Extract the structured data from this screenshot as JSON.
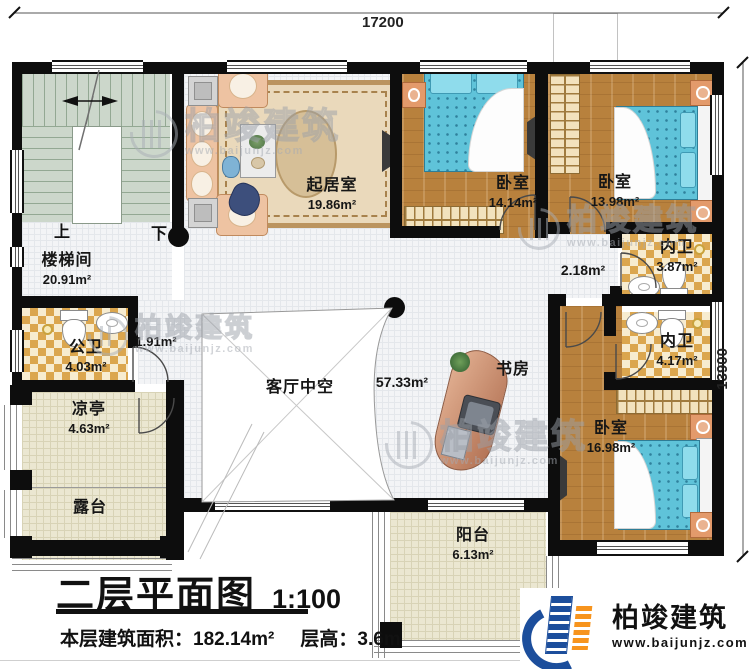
{
  "dimensions": {
    "top": "17200",
    "right": "13900"
  },
  "rooms": {
    "stairwell": {
      "name": "楼梯间",
      "area": "20.91m²"
    },
    "living": {
      "name": "起居室",
      "area": "19.86m²"
    },
    "bedroom1": {
      "name": "卧室",
      "area": "14.14m²"
    },
    "bedroom2": {
      "name": "卧室",
      "area": "13.98m²"
    },
    "bath1": {
      "name": "内卫",
      "area": "3.87m²"
    },
    "hall_nook": {
      "area": "2.18m²"
    },
    "bath2": {
      "name": "内卫",
      "area": "4.17m²"
    },
    "bedroom3": {
      "name": "卧室",
      "area": "16.98m²"
    },
    "study": {
      "name": "书房"
    },
    "hall": {
      "name": "客厅中空",
      "area": "57.33m²"
    },
    "public_bath": {
      "name": "公卫",
      "area": "4.03m²"
    },
    "corridor": {
      "area": "1.91m²"
    },
    "pavilion": {
      "name": "凉亭",
      "area": "4.63m²"
    },
    "terrace": {
      "name": "露台"
    },
    "balcony": {
      "name": "阳台",
      "area": "6.13m²"
    }
  },
  "stairs": {
    "up": "上",
    "down": "下"
  },
  "title": {
    "main": "二层平面图",
    "scale": "1:100",
    "area_label": "本层建筑面积：",
    "area_value": "182.14m²",
    "height_label": "层高：",
    "height_value": "3.6m"
  },
  "logo": {
    "company": "柏竣建筑",
    "website": "www.baijunjz.com"
  },
  "watermark": {
    "text": "柏竣建筑",
    "subtext": "www.baijunjz.com"
  },
  "colors": {
    "wall": "#0d0d0d",
    "wood_floor": "#b8813d",
    "bed_blue": "#5fc3d9",
    "bath_checker": "#dba64e",
    "outdoor_tile": "#ebe7d1",
    "stair_green": "#ccd7cb",
    "logo_blue": "#1c4e9c",
    "logo_orange": "#f7941d"
  }
}
